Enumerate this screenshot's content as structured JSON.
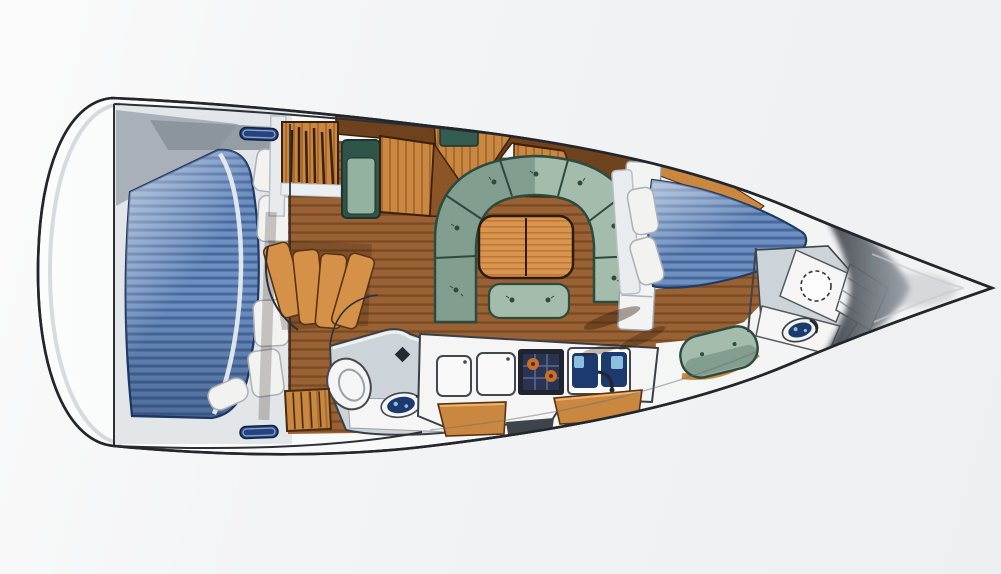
{
  "scene": {
    "type": "sailboat-interior-floor-plan-illustration",
    "orientation": {
      "bow": "right",
      "stern": "left"
    },
    "style": "hand-drawn color rendering, top-down deck plan, no text labels"
  },
  "colors": {
    "background_top": "#fbfbfb",
    "background": "#edeff1",
    "hull_outline": "#23272d",
    "deck": "#f7f8f7",
    "deck_shade": "#ccd2d7",
    "berth_base": "#6d90c1",
    "berth_stripe": "#49699d",
    "berth_outline": "#1f3a66",
    "pillow": "#f2f3f1",
    "floor": "#9a6234",
    "floor_stripe": "#784b24",
    "cabinet": "#c9873f",
    "cabinet_dark": "#6f421e",
    "cabinet_grain": "#8d5426",
    "table": "#d9954e",
    "table_grain": "#b06a2e",
    "green": "#a3bcab",
    "green_dark": "#6f8f7e",
    "green_seam": "#2c4a3e",
    "nav_seat_green": "#2f544a",
    "counter": "#f4f5f4",
    "fixture_outline": "#44484e",
    "navy": "#1c3a6e",
    "water": "#8ebede",
    "burner_orange": "#c96f2e",
    "stove_body": "#20242c",
    "stove_grate": "#2a3350",
    "hatch_blue": "#27427c",
    "hatch_line": "#7fa0cc",
    "head_floor": "#ccd4da",
    "wall_grey": "#9aa2ab",
    "shadow": "#3c3f45"
  },
  "regions": [
    {
      "id": "aft-cabin",
      "furniture": [
        "double-berth-blue-striped",
        "four-white-pillows",
        "folded-blanket"
      ]
    },
    {
      "id": "companionway",
      "furniture": [
        "curved-steps",
        "bookshelf",
        "bulkhead-door"
      ]
    },
    {
      "id": "nav-station",
      "furniture": [
        "chart-table",
        "nav-seat"
      ]
    },
    {
      "id": "saloon",
      "furniture": [
        "u-shaped-settee",
        "folding-table",
        "aft-bench",
        "shelf-column",
        "overhead-lockers"
      ]
    },
    {
      "id": "aft-head",
      "furniture": [
        "toilet",
        "washbasin",
        "hanging-locker"
      ]
    },
    {
      "id": "galley",
      "furniture": [
        "fridge-lid",
        "fridge-lid",
        "two-burner-stove",
        "double-sink",
        "locker-fronts"
      ]
    },
    {
      "id": "forward-cabin",
      "furniture": [
        "v-berth-blue-striped",
        "two-white-pillows",
        "green-stool"
      ]
    },
    {
      "id": "forward-head",
      "furniture": [
        "toilet",
        "washbasin",
        "corner-shelves"
      ]
    },
    {
      "id": "bow",
      "furniture": [
        "anchor-locker-shadow"
      ]
    }
  ],
  "deck": {
    "hatch_count": 4,
    "hatch_positions": [
      "aft-top",
      "mid-top",
      "forward-top",
      "aft-bottom"
    ]
  }
}
